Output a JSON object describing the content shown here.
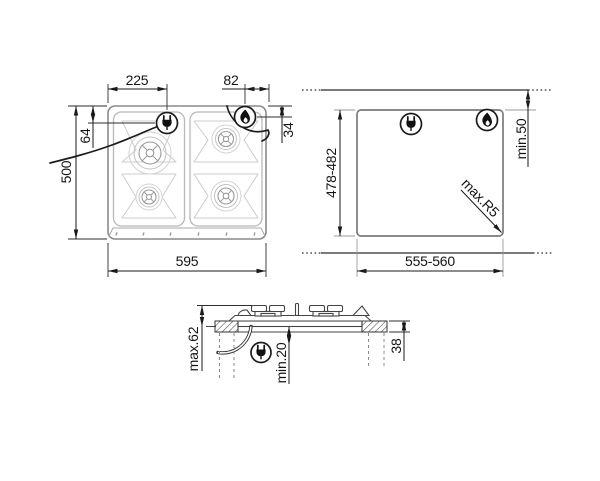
{
  "views": {
    "top": {
      "label": "hob-top-view",
      "dims": {
        "width": "595",
        "height": "500",
        "plug_from_left": "225",
        "plug_from_top": "64",
        "flame_from_right": "82",
        "flame_from_top": "34"
      }
    },
    "cutout": {
      "label": "worktop-cutout-view",
      "dims": {
        "width": "555-560",
        "depth": "478-482",
        "rear_clearance": "min.50",
        "corner_radius": "max.R5"
      }
    },
    "side": {
      "label": "side-section-view",
      "dims": {
        "overall_height": "max.62",
        "under_clearance": "min.20",
        "worktop_thickness": "38"
      }
    }
  },
  "icons": {
    "plug": "power-plug-icon",
    "flame": "gas-flame-icon"
  },
  "colors": {
    "line": "#1a1a1a",
    "shape": "#8a8a8a",
    "background": "#ffffff"
  }
}
